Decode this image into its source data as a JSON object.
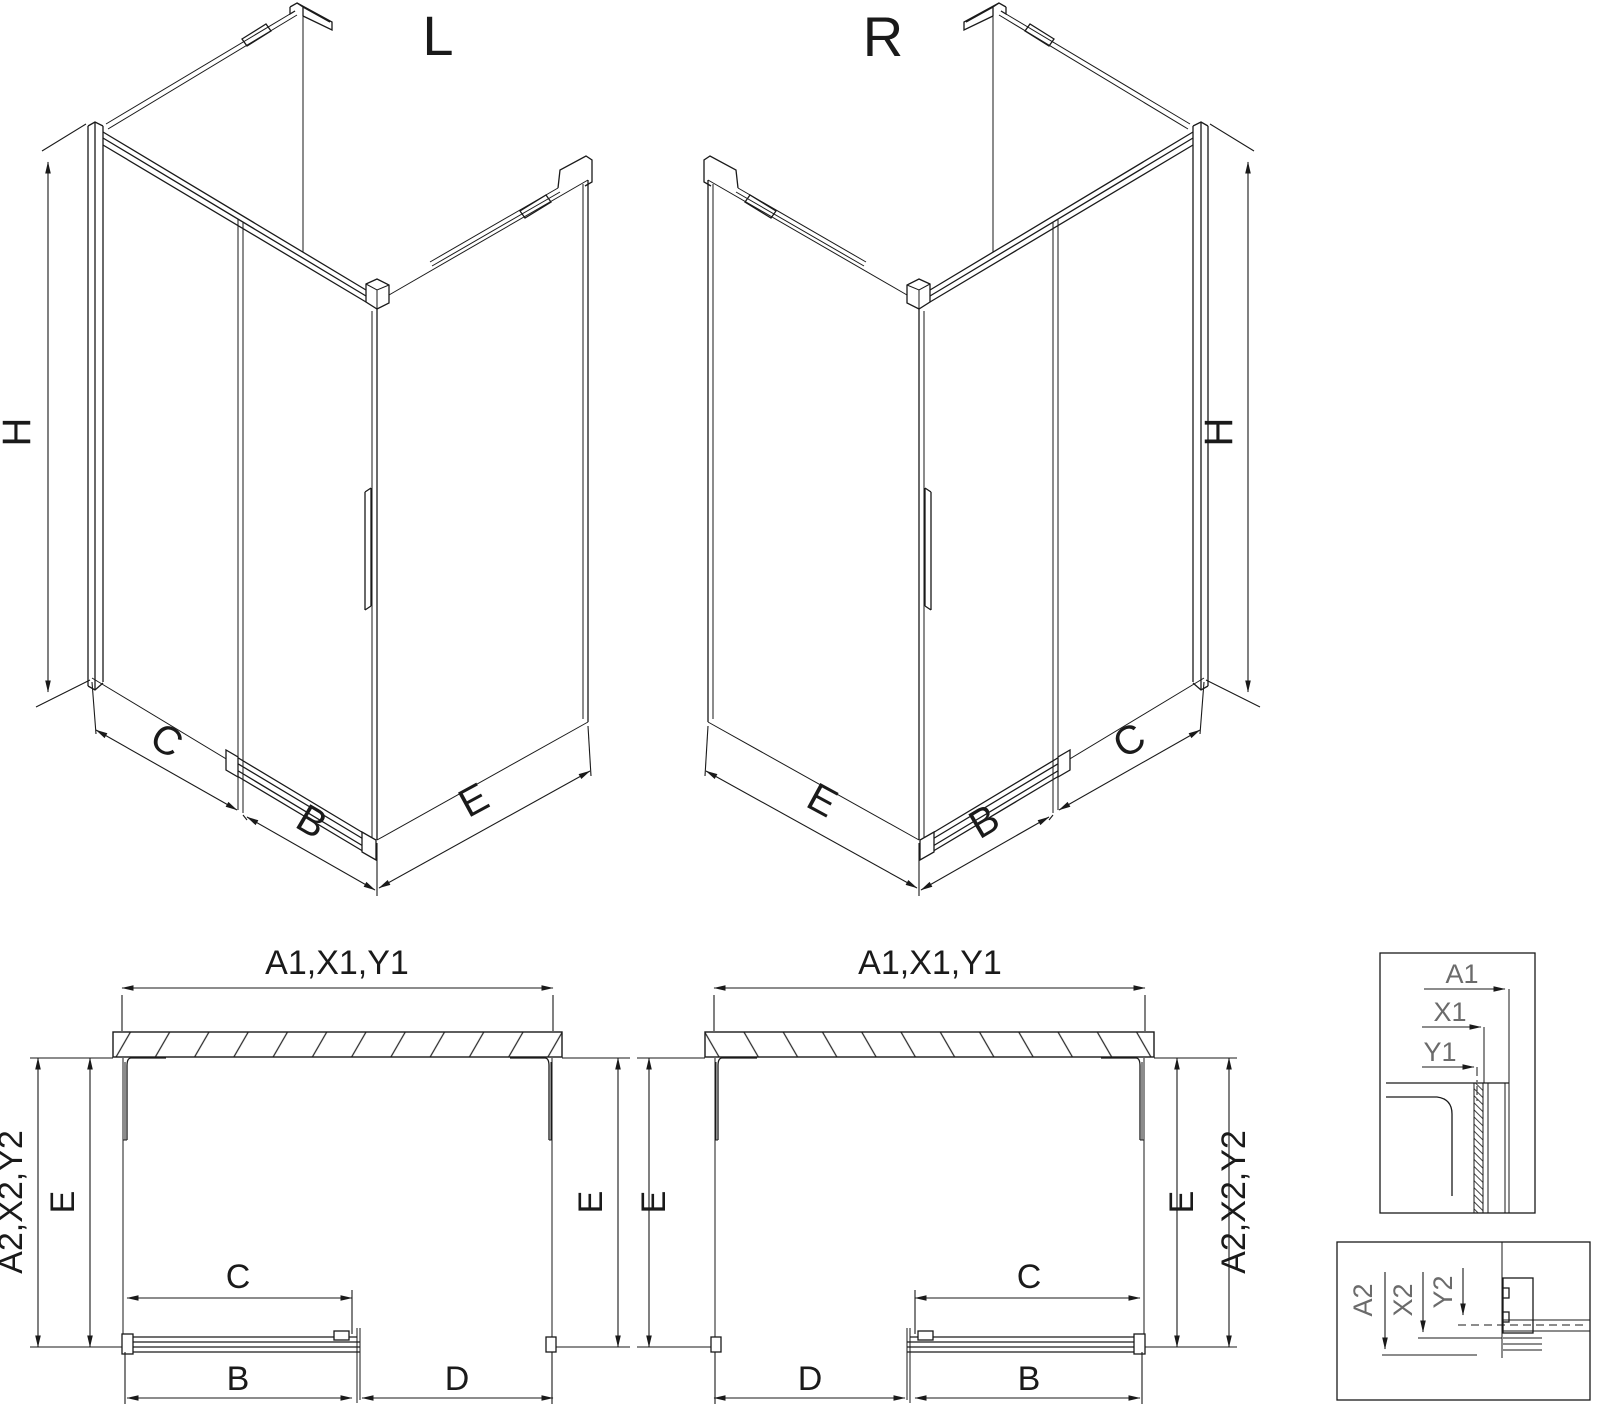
{
  "page": {
    "background_color": "#ffffff",
    "line_color": "#1a1a1a",
    "detail_label_color": "#6b6b6b"
  },
  "iso_left": {
    "title": "L",
    "height_label": "H",
    "fixed_panel_label": "C",
    "door_label": "B",
    "side_panel_label": "E"
  },
  "iso_right": {
    "title": "R",
    "height_label": "H",
    "fixed_panel_label": "C",
    "door_label": "B",
    "side_panel_label": "E"
  },
  "plan_left": {
    "width_label": "A1,X1,Y1",
    "depth_label": "A2,X2,Y2",
    "e_left": "E",
    "e_right": "E",
    "c": "C",
    "b": "B",
    "d": "D"
  },
  "plan_right": {
    "width_label": "A1,X1,Y1",
    "depth_label": "A2,X2,Y2",
    "e_left": "E",
    "e_right": "E",
    "c": "C",
    "b": "B",
    "d": "D"
  },
  "detail_top": {
    "a1": "A1",
    "x1": "X1",
    "y1": "Y1"
  },
  "detail_bottom": {
    "a2": "A2",
    "x2": "X2",
    "y2": "Y2"
  }
}
